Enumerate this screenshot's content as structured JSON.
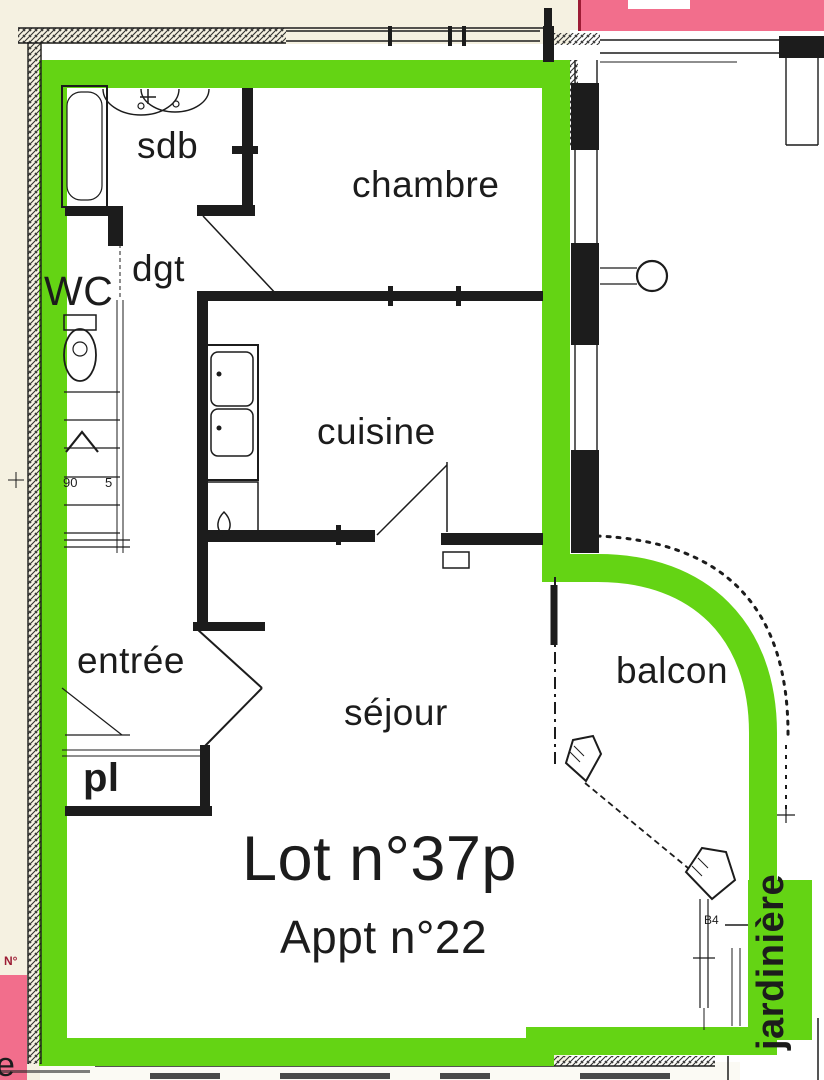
{
  "plan": {
    "lot_title": "Lot n°37p",
    "apartment_subtitle": "Appt n°22",
    "rooms": {
      "sdb": "sdb",
      "chambre": "chambre",
      "wc": "WC",
      "dgt": "dgt",
      "cuisine": "cuisine",
      "entree": "entrée",
      "sejour": "séjour",
      "placard": "pl",
      "balcon": "balcon",
      "jardiniere": "jardinière"
    },
    "annotations": {
      "stair_width": "90",
      "stair_riser": "5",
      "balcony_mark": "B4",
      "cutoff_letter": "e",
      "neighbor_mark": "N°"
    },
    "colors": {
      "highlight_green": "#64d414",
      "zone_pink": "#f26e8c",
      "zone_pink_edge": "#9c1c34",
      "background_cream": "#f5f1e1",
      "ink": "#1c1c1c"
    }
  }
}
